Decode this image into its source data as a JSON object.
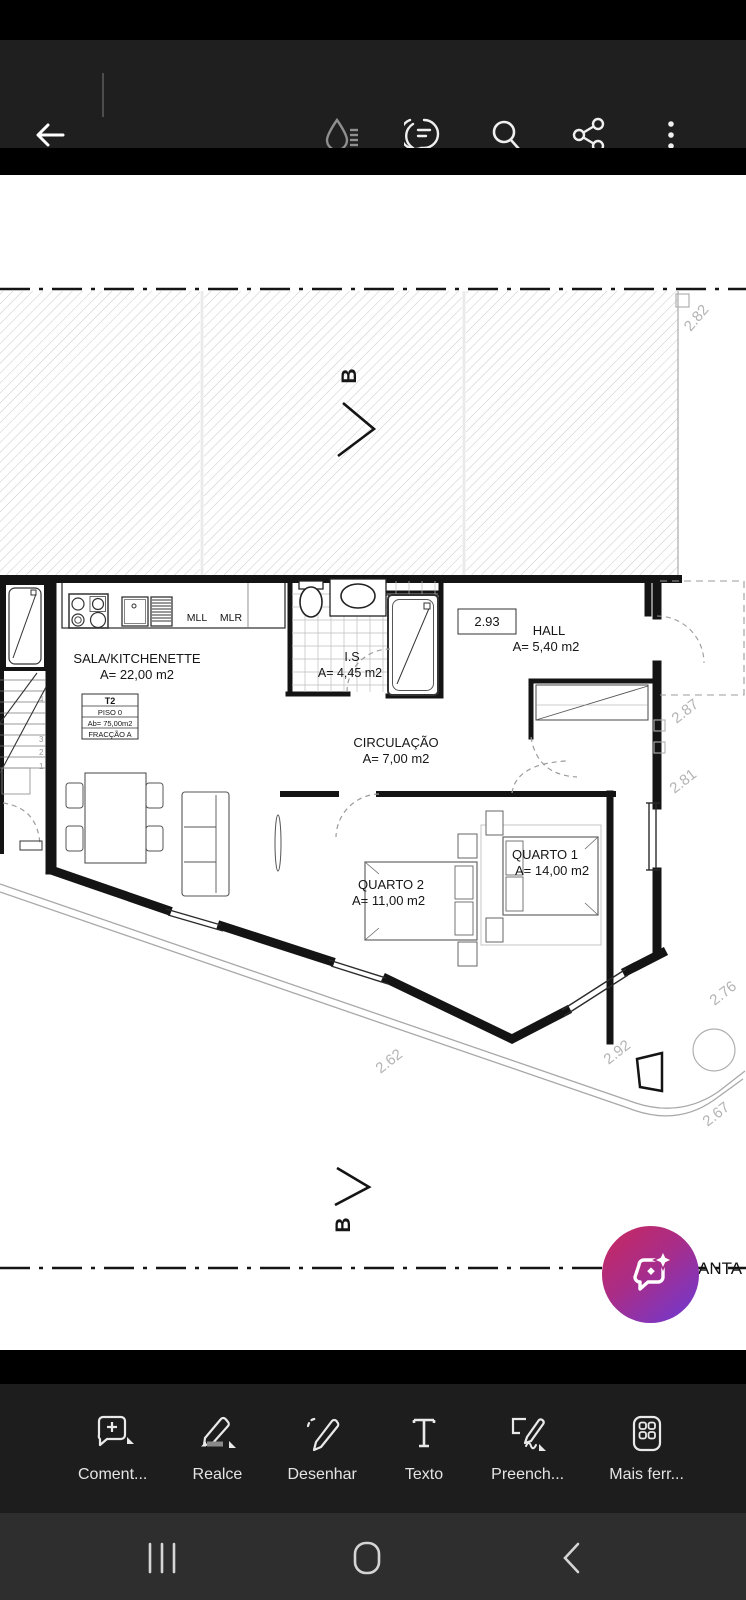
{
  "app": {
    "drawing_title_partial": "ANTA"
  },
  "plan": {
    "rooms": {
      "sala": {
        "name": "SALA/KITCHENETTE",
        "area": "A= 22,00 m2"
      },
      "is": {
        "name": "I.S",
        "area": "A= 4,45 m2"
      },
      "hall": {
        "name": "HALL",
        "area": "A= 5,40 m2"
      },
      "circulacao": {
        "name": "CIRCULAÇÃO",
        "area": "A= 7,00 m2"
      },
      "quarto1": {
        "name": "QUARTO 1",
        "area": "A= 14,00 m2"
      },
      "quarto2": {
        "name": "QUARTO 2",
        "area": "A= 11,00 m2"
      }
    },
    "unit_box": {
      "line1": "T2",
      "line2": "PISO 0",
      "line3": "Ab= 75,00m2",
      "line4": "FRACÇÃO A"
    },
    "kitchen_labels": {
      "mll": "MLL",
      "mlr": "MLR"
    },
    "dimensions": {
      "hall_width": "2.93",
      "top_right": "2.82",
      "right_upper": "2.87",
      "right_lower": "2.81",
      "right_bedroom": "2.76",
      "bottom_middle": "2.92",
      "bottom_right": "2.67",
      "bottom_left": "2.62"
    },
    "section_marker": "B",
    "stairs": [
      "4",
      "3",
      "2",
      "1"
    ]
  },
  "toolbar": {
    "items": [
      {
        "label": "Coment..."
      },
      {
        "label": "Realce"
      },
      {
        "label": "Desenhar"
      },
      {
        "label": "Texto"
      },
      {
        "label": "Preench..."
      },
      {
        "label": "Mais ferr..."
      }
    ]
  },
  "colors": {
    "fab_gradient_start": "#c9285e",
    "fab_gradient_end": "#6b3ad6",
    "appbar_bg": "#1f1f1f",
    "toolbar_bg": "#1d1d1d",
    "navbar_bg": "#2e2e2e",
    "accent_disabled": "#8f8f8f"
  }
}
